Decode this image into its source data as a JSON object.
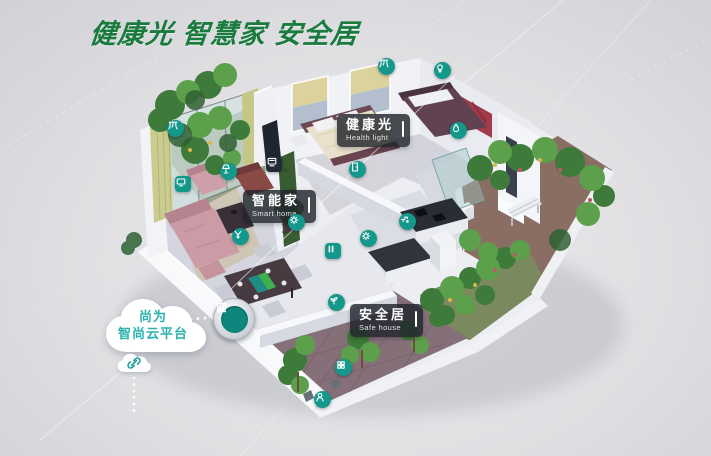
{
  "title": {
    "text": "健康光 智慧家 安全居"
  },
  "cloud_badge": {
    "line1": "尚为",
    "line2": "智尚云平台"
  },
  "labels": [
    {
      "zh": "健康光",
      "en": "Health light"
    },
    {
      "zh": "智能家",
      "en": "Smart home"
    },
    {
      "zh": "安全居",
      "en": "Safe house"
    }
  ],
  "icons": [
    {
      "name": "balcony-curtain-icon",
      "glyph": "curtain",
      "shape": "circle",
      "x": 175,
      "y": 128
    },
    {
      "name": "bedroom-curtain-icon",
      "glyph": "curtain",
      "shape": "circle",
      "x": 386,
      "y": 66
    },
    {
      "name": "ceiling-light-icon",
      "glyph": "bulb",
      "shape": "circle",
      "x": 442,
      "y": 70
    },
    {
      "name": "living-room-lamp-icon",
      "glyph": "lamp",
      "shape": "circle",
      "x": 228,
      "y": 171
    },
    {
      "name": "tv-icon",
      "glyph": "tv",
      "shape": "square",
      "x": 183,
      "y": 184
    },
    {
      "name": "wall-screen-icon",
      "glyph": "screen",
      "shape": "square-dark",
      "x": 274,
      "y": 164
    },
    {
      "name": "voice-speaker-icon",
      "glyph": "speaker",
      "shape": "circle",
      "x": 240,
      "y": 236
    },
    {
      "name": "door-sensor-icon",
      "glyph": "door",
      "shape": "circle",
      "x": 357,
      "y": 169
    },
    {
      "name": "scene-switch-icon",
      "glyph": "gear",
      "shape": "circle",
      "x": 296,
      "y": 222
    },
    {
      "name": "switch-panel-icon",
      "glyph": "switch",
      "shape": "square",
      "x": 333,
      "y": 251
    },
    {
      "name": "gas-sensor-icon",
      "glyph": "gear",
      "shape": "circle",
      "x": 368,
      "y": 238
    },
    {
      "name": "water-faucet-icon",
      "glyph": "faucet",
      "shape": "circle",
      "x": 407,
      "y": 221
    },
    {
      "name": "bathroom-water-icon",
      "glyph": "drop",
      "shape": "circle",
      "x": 458,
      "y": 130
    },
    {
      "name": "garden-irrigation-icon",
      "glyph": "plant",
      "shape": "circle",
      "x": 336,
      "y": 302
    },
    {
      "name": "courtyard-keypad-icon",
      "glyph": "keypad",
      "shape": "circle",
      "x": 343,
      "y": 367
    },
    {
      "name": "access-control-icon",
      "glyph": "person",
      "shape": "circle",
      "x": 322,
      "y": 399
    }
  ],
  "colors": {
    "accent_teal": "#14988c",
    "title_green": "#1a7b3e",
    "cloud_text_teal": "#2ab3ac",
    "label_bg": "rgba(33,37,44,0.82)"
  }
}
